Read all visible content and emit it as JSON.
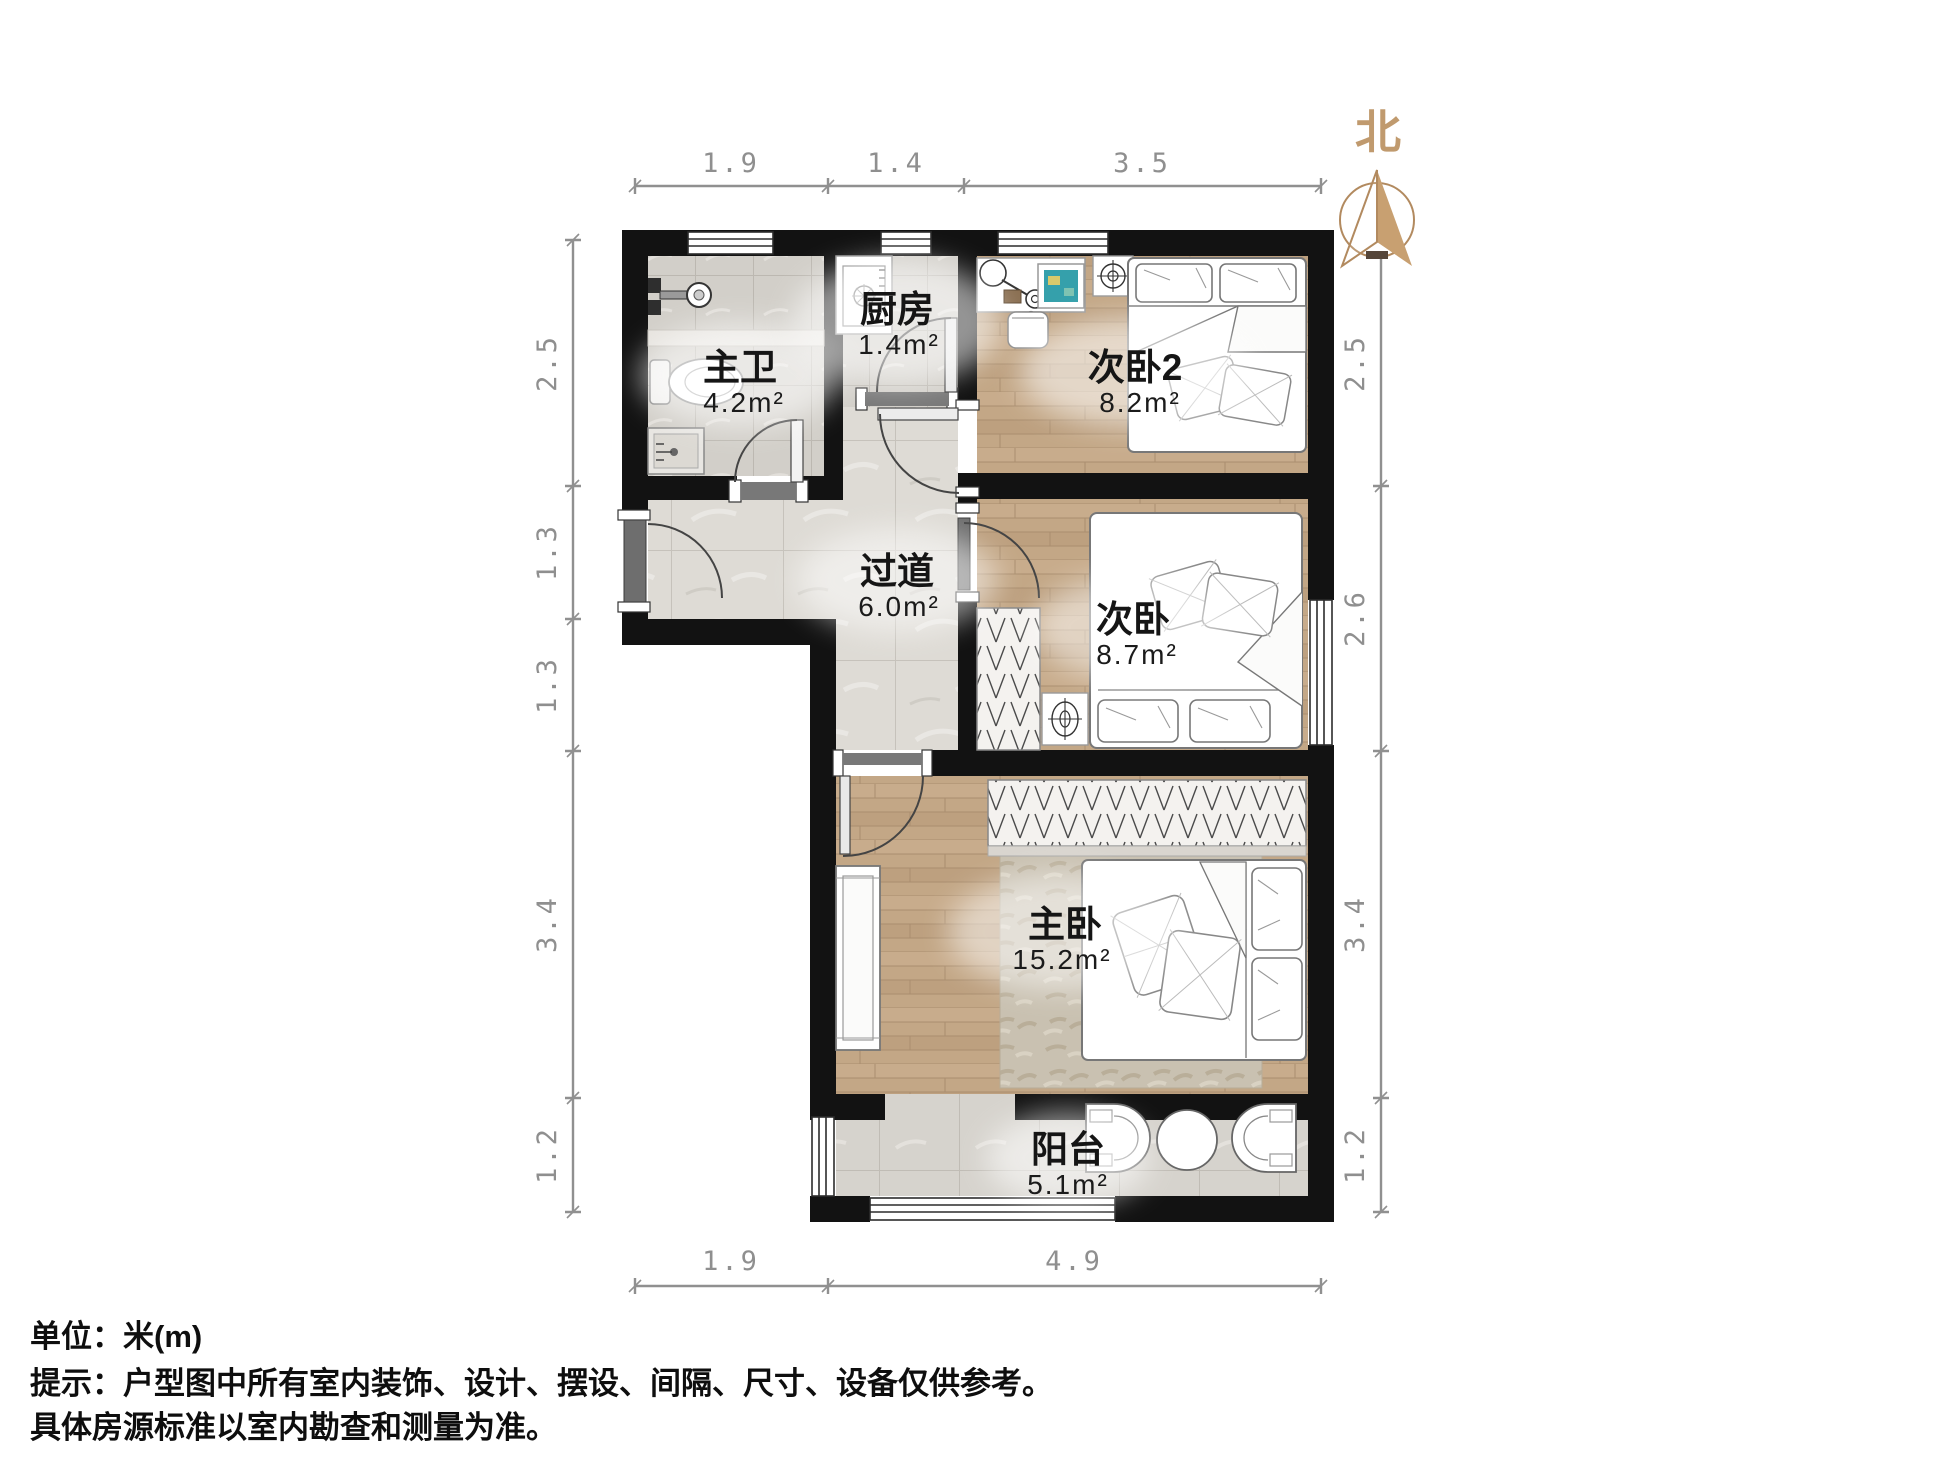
{
  "north_label": "北",
  "rooms": [
    {
      "id": "master-bath",
      "name": "主卫",
      "area": "4.2m²"
    },
    {
      "id": "kitchen",
      "name": "厨房",
      "area": "1.4m²"
    },
    {
      "id": "bedroom2",
      "name": "次卧2",
      "area": "8.2m²"
    },
    {
      "id": "hallway",
      "name": "过道",
      "area": "6.0m²"
    },
    {
      "id": "bedroom",
      "name": "次卧",
      "area": "8.7m²"
    },
    {
      "id": "master-bedroom",
      "name": "主卧",
      "area": "15.2m²"
    },
    {
      "id": "balcony",
      "name": "阳台",
      "area": "5.1m²"
    }
  ],
  "dimensions": {
    "top": [
      "1.9",
      "1.4",
      "3.5"
    ],
    "left": [
      "2.5",
      "1.3",
      "1.3",
      "3.4",
      "1.2"
    ],
    "right": [
      "2.5",
      "2.6",
      "3.4",
      "1.2"
    ],
    "bottom": [
      "1.9",
      "4.9"
    ]
  },
  "notes": {
    "unit": "单位：米(m)",
    "tip1": "提示：户型图中所有室内装饰、设计、摆设、间隔、尺寸、设备仅供参考。",
    "tip2": "具体房源标准以室内勘查和测量为准。"
  },
  "colors": {
    "wall": "#121212",
    "wood_floor": "#c3a786",
    "tile_hall": "#dedbd5",
    "tile_bath": "#d2cfc9",
    "north_accent": "#c09a6e",
    "dim_text": "#8f8f8f"
  }
}
